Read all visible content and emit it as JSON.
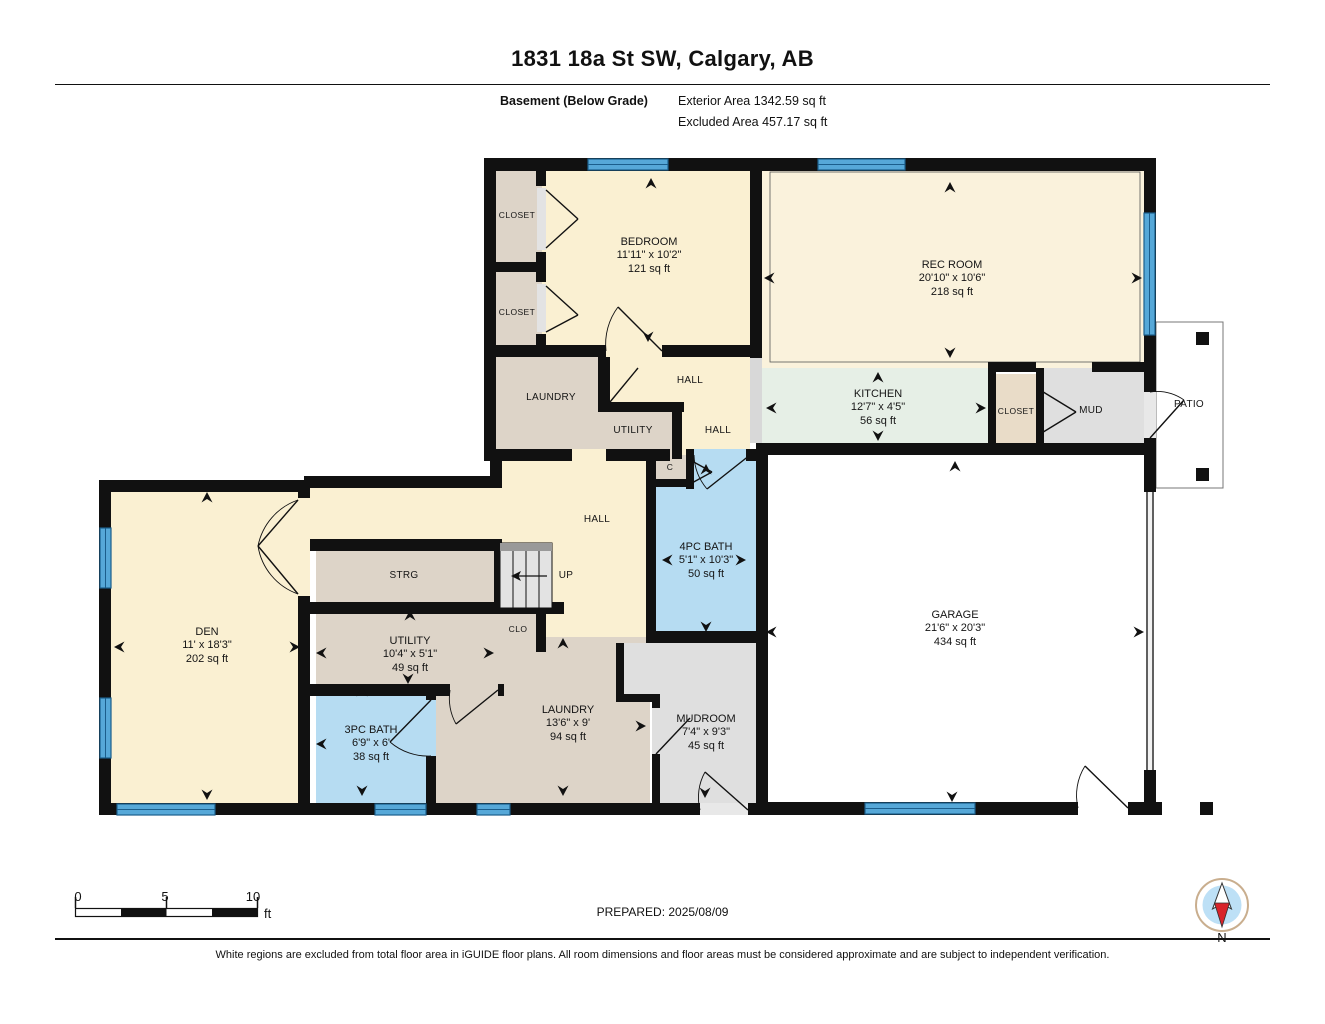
{
  "title": "1831 18a St SW, Calgary, AB",
  "floor": {
    "name": "Basement (Below Grade)",
    "exterior_area": "Exterior Area 1342.59 sq ft",
    "excluded_area": "Excluded Area 457.17 sq ft"
  },
  "rooms": {
    "bedroom": {
      "name": "BEDROOM",
      "dims": "11'11\" x 10'2\"",
      "area": "121 sq ft"
    },
    "rec_room": {
      "name": "REC ROOM",
      "dims": "20'10\" x 10'6\"",
      "area": "218 sq ft"
    },
    "kitchen": {
      "name": "KITCHEN",
      "dims": "12'7\" x 4'5\"",
      "area": "56 sq ft"
    },
    "den": {
      "name": "DEN",
      "dims": "11' x 18'3\"",
      "area": "202 sq ft"
    },
    "garage": {
      "name": "GARAGE",
      "dims": "21'6\" x 20'3\"",
      "area": "434 sq ft"
    },
    "bath_4pc": {
      "name": "4PC BATH",
      "dims": "5'1\" x 10'3\"",
      "area": "50 sq ft"
    },
    "bath_3pc": {
      "name": "3PC BATH",
      "dims": "6'9\" x 6'",
      "area": "38 sq ft"
    },
    "laundry_lower": {
      "name": "LAUNDRY",
      "dims": "13'6\" x 9'",
      "area": "94 sq ft"
    },
    "utility_lower": {
      "name": "UTILITY",
      "dims": "10'4\" x 5'1\"",
      "area": "49 sq ft"
    },
    "mudroom": {
      "name": "MUDROOM",
      "dims": "7'4\" x 9'3\"",
      "area": "45 sq ft"
    },
    "laundry_upper": {
      "name": "LAUNDRY"
    },
    "utility_upper": {
      "name": "UTILITY"
    },
    "hall_upper": {
      "name": "HALL"
    },
    "hall_mid": {
      "name": "HALL"
    },
    "hall_center": {
      "name": "HALL"
    },
    "strg": {
      "name": "STRG"
    },
    "clo": {
      "name": "CLO"
    },
    "c_closet": {
      "name": "C"
    },
    "closet_top": {
      "name": "CLOSET"
    },
    "closet_bottom": {
      "name": "CLOSET"
    },
    "closet_kitchen": {
      "name": "CLOSET"
    },
    "mud": {
      "name": "MUD"
    },
    "patio": {
      "name": "PATIO"
    },
    "up": {
      "name": "UP"
    }
  },
  "scale_bar": {
    "tick0": "0",
    "tick5": "5",
    "tick10": "10",
    "unit": "ft"
  },
  "compass": {
    "label": "N"
  },
  "prepared": "PREPARED: 2025/08/09",
  "disclaimer": "White regions are excluded from total floor area in iGUIDE floor plans. All room dimensions and floor areas must be considered approximate and are subject to independent verification.",
  "colors": {
    "room_cream": "#FAF0D2",
    "rec_cream": "#FAF2DC",
    "closet_tan": "#DDD4C8",
    "kitchen_green": "#E6EFE6",
    "bath_blue": "#B6DCF2",
    "mud_gray": "#DFDFDF",
    "window_blue": "#56A8D8",
    "wall_black": "#111111",
    "compass_red": "#D8232A",
    "compass_blue": "#BDE0F6"
  }
}
